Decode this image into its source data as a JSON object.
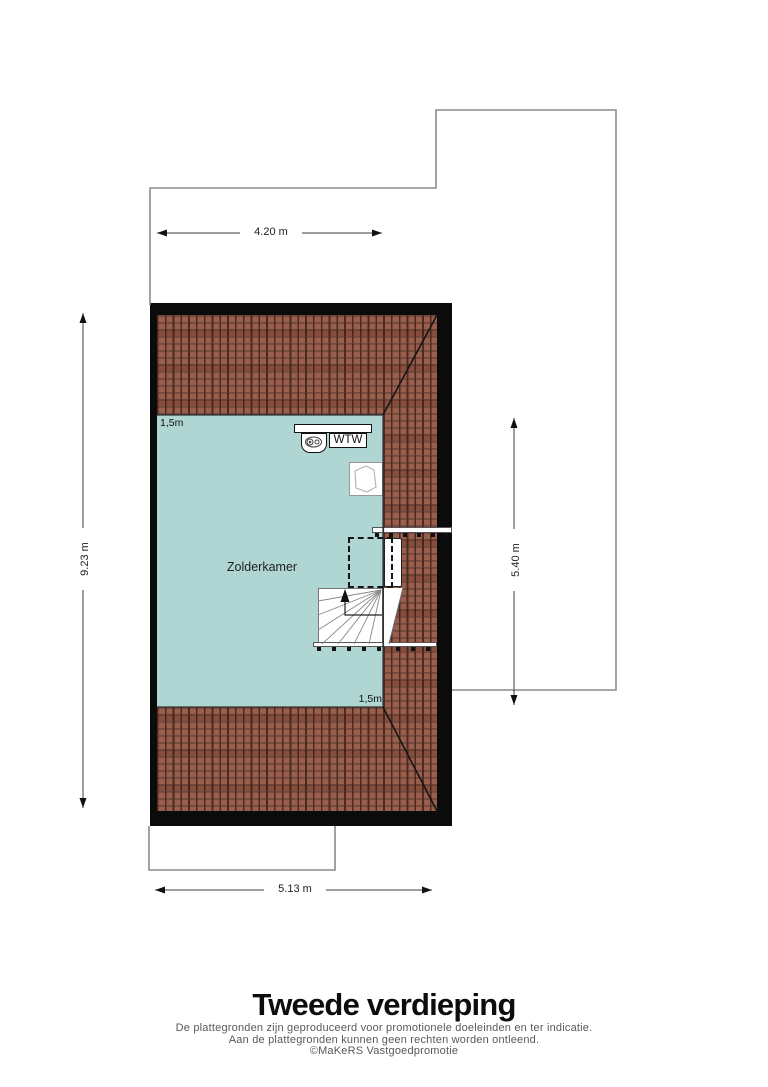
{
  "floorplan": {
    "room": {
      "label": "Zolderkamer"
    },
    "wtw": {
      "label": "WTW"
    },
    "height_markers": {
      "top": "1,5m",
      "bottom": "1,5m"
    },
    "dimensions": {
      "top": "4.20 m",
      "left": "9.23 m",
      "right": "5.40 m",
      "bottom": "5.13 m"
    },
    "colors": {
      "room_fill": "#afd6d3",
      "roof_tile": "#9a5e4c",
      "wall": "#0b0b0b"
    }
  },
  "footer": {
    "title": "Tweede verdieping",
    "disclaimer_line1": "De plattegronden zijn geproduceerd voor promotionele doeleinden en ter indicatie.",
    "disclaimer_line2": "Aan de plattegronden kunnen geen rechten worden ontleend.",
    "copyright": "©MaKeRS Vastgoedpromotie"
  }
}
